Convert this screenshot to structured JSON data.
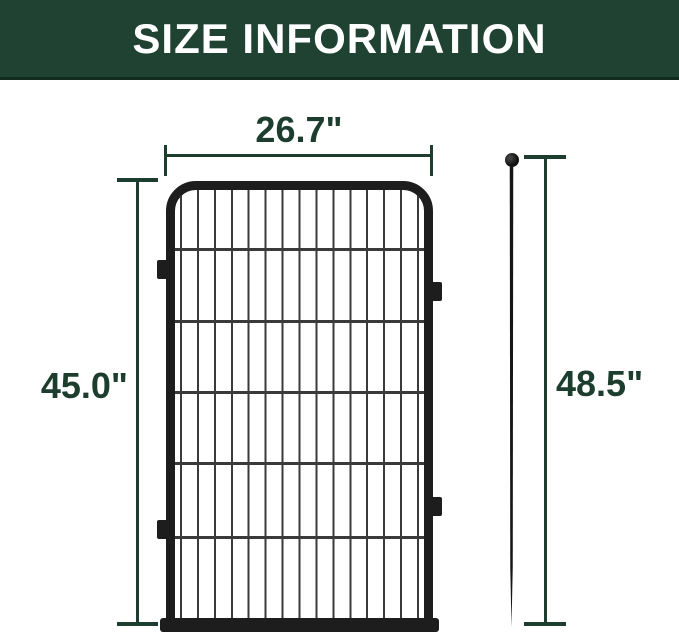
{
  "header": {
    "title": "SIZE INFORMATION"
  },
  "colors": {
    "banner_bg": "#1f4233",
    "banner_edge": "#122b1f",
    "banner_text": "#ffffff",
    "dimension": "#1d3e2e",
    "frame": "#1d1d1d",
    "wire": "#3a3a3a",
    "background": "#ffffff"
  },
  "diagram": {
    "panel_width_label": "26.7\"",
    "panel_height_label": "45.0\"",
    "stake_height_label": "48.5\""
  }
}
